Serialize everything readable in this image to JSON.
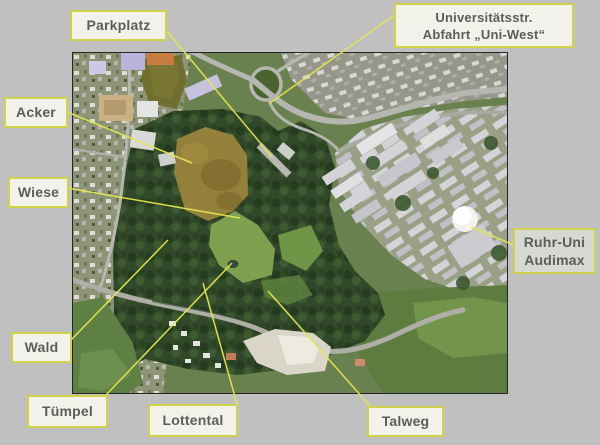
{
  "window": {
    "background": "#c0c0c0"
  },
  "map": {
    "kind": "aerial-photograph",
    "border_color": "#242424",
    "features": [
      "residential area",
      "highway interchange with loop ramp",
      "brown plowed field",
      "green meadow",
      "dark forest",
      "university campus buildings",
      "white dome",
      "valley road",
      "gravel clearing",
      "pond"
    ]
  },
  "labels": [
    {
      "id": "parkplatz",
      "lines": [
        "Parkplatz"
      ]
    },
    {
      "id": "uni",
      "lines": [
        "Universitätsstr.",
        "Abfahrt „Uni-West“"
      ]
    },
    {
      "id": "acker",
      "lines": [
        "Acker"
      ]
    },
    {
      "id": "wiese",
      "lines": [
        "Wiese"
      ]
    },
    {
      "id": "audimax",
      "lines": [
        "Ruhr-Uni",
        "Audimax"
      ]
    },
    {
      "id": "wald",
      "lines": [
        "Wald"
      ]
    },
    {
      "id": "tuempel",
      "lines": [
        "Tümpel"
      ]
    },
    {
      "id": "lottental",
      "lines": [
        "Lottental"
      ]
    },
    {
      "id": "talweg",
      "lines": [
        "Talweg"
      ]
    }
  ],
  "colors": {
    "label_fill": "#f2f2ea",
    "label_fill_gray": "#d6d8d2",
    "label_border": "#d2d24a",
    "label_text": "#5c5c5c",
    "callout_line": "#e6e64e"
  }
}
